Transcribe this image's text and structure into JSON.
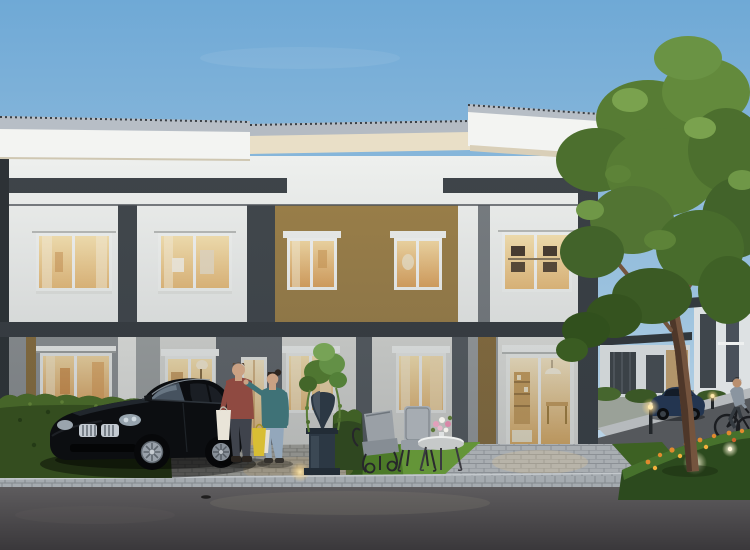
{
  "scene": {
    "type": "architectural-rendering-photo",
    "time_of_day": "dusk",
    "subject": "two-story modern townhouse row with lit windows",
    "elements": [
      "evening-sky",
      "flat-roof-with-gray-gutter",
      "white-facade",
      "gold-accent-panels",
      "dark-gray-accent-stripes-and-pilasters",
      "five-upper-windows-lit",
      "four-ground-windows-lit",
      "glass-entry-door-lit",
      "black-sedan-parked",
      "couple-with-shopping-bags",
      "trimmed-hedge",
      "ornamental-urn-planter",
      "garden-chairs-and-white-coffee-table",
      "paver-driveway",
      "paver-walkway",
      "curb-stones",
      "asphalt-road",
      "right-garden-with-orange-flowers-and-path-lights",
      "large-tree",
      "background-houses",
      "background-blue-car",
      "background-cyclist"
    ],
    "visible_text": ""
  },
  "palette": {
    "sky-top": "#6fa9d6",
    "sky-horizon": "#cfe0ec",
    "roof-cap": "#b7bec6",
    "fascia-white": "#f3f4f2",
    "soffit-cream": "#e9dfc7",
    "wall-white": "#eef0ee",
    "wall-ground": "#d9dad6",
    "wall-gray": "#8e9294",
    "accent-gold": "#9c8049",
    "accent-gold-dark": "#8a6f3e",
    "accent-dark": "#3e4449",
    "pilaster": "#41474c",
    "window-frame": "#f2f4f2",
    "hedge-green": "#344d1f",
    "lawn-green": "#4c7a28",
    "lawn-bright": "#6a9c3c",
    "foliage-mid": "#577c34",
    "trunk-brown": "#74543e",
    "driveway-paver": "#8f908c",
    "walkway-paver": "#a9aeb2",
    "curb-gray": "#a5abb0",
    "road-top": "#5e5c5e",
    "road-bottom": "#403e41",
    "car-black": "#0c0e11",
    "chrome": "#c3cad1",
    "car-blue": "#233550",
    "shirt-maroon": "#8f4a41",
    "hoodie-teal": "#3f7277",
    "jeans-dark": "#3f434c",
    "jeans-light": "#93a7bb",
    "bag-white": "#e9e4d8",
    "bag-yellow": "#d8be34",
    "flower-orange": "#e08a2e",
    "flower-pink": "#e2a0bb",
    "urn-dark": "#2c3844",
    "table-white": "#eef0ef",
    "house-bg": "#cfd4d6",
    "glazing-dark": "#3b4247",
    "sidewalk": "#b6babd"
  }
}
